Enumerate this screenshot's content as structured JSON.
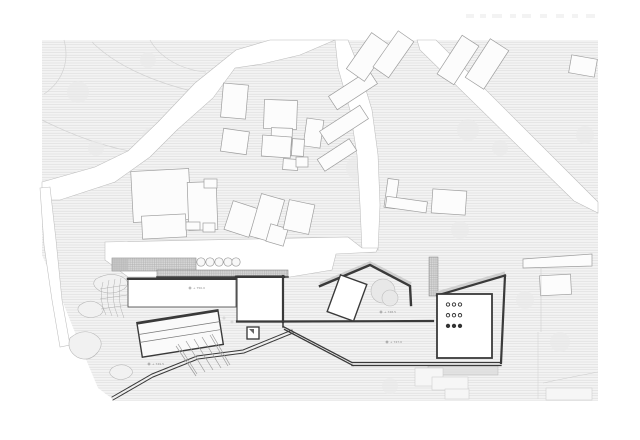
{
  "drawing": {
    "kind_label": "site plan",
    "elevation_markers": [
      {
        "x": 190,
        "y": 288,
        "label": "+ 750.0"
      },
      {
        "x": 381,
        "y": 312,
        "label": "+ 748.5"
      },
      {
        "x": 387,
        "y": 342,
        "label": "+ 747.0"
      },
      {
        "x": 149,
        "y": 364,
        "label": "+ 749.5"
      }
    ],
    "pavilion_dots": {
      "rows": 3,
      "cols": 3,
      "filled_rows": 1,
      "open_rows": 2
    },
    "colors": {
      "paper": "#ffffff",
      "terrain_hatch_bg": "#f3f3f3",
      "terrain_hatch_line": "#d9d9d9",
      "building_fill": "#fcfcfc",
      "building_stroke": "#9e9e9e",
      "design_stroke": "#3a3a3a",
      "marker_text": "#8f8f8f"
    }
  }
}
